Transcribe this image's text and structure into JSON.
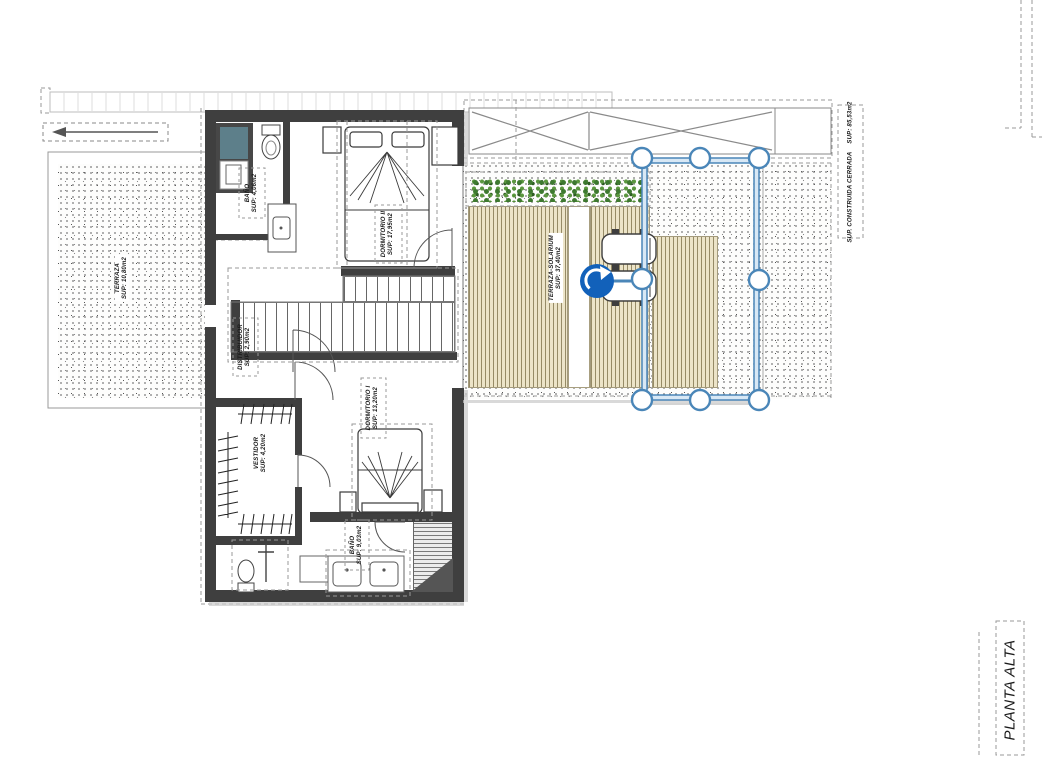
{
  "plan": {
    "title": "PLANTA ALTA",
    "rooms": [
      {
        "id": "terraza",
        "name": "TERRAZA",
        "area": "SUP: 10,80m2"
      },
      {
        "id": "bano_superior",
        "name": "BAÑO",
        "area": "SUP: 4,06m2"
      },
      {
        "id": "dormitorio_2",
        "name": "DORMITORIO II",
        "area": "SUP: 17,95m2"
      },
      {
        "id": "distribuidor",
        "name": "DISTRIBUIDOR",
        "area": "SUP: 2,90m2"
      },
      {
        "id": "dormitorio_1",
        "name": "DORMITORIO I",
        "area": "SUP: 13,20m2"
      },
      {
        "id": "vestidor",
        "name": "VESTIDOR",
        "area": "SUP: 4,20m2"
      },
      {
        "id": "bano_inferior",
        "name": "BAÑO",
        "area": "SUP: 9,03m2"
      },
      {
        "id": "terraza_solarium",
        "name": "TERRAZA-SOLARIUM",
        "area": "SUP: 37,40m2"
      }
    ],
    "annotations": {
      "construida_label": "SUP. CONSTRUIDA CERRADA",
      "construida_area": "SUP: 85,53m2",
      "sheet_title": "PLANTA ALTA"
    }
  },
  "selection": {
    "handle_count": 8,
    "accent_color": "#4a86b8",
    "rotate_icon_color": "#1261ba",
    "selected_object": "sun-loungers"
  }
}
